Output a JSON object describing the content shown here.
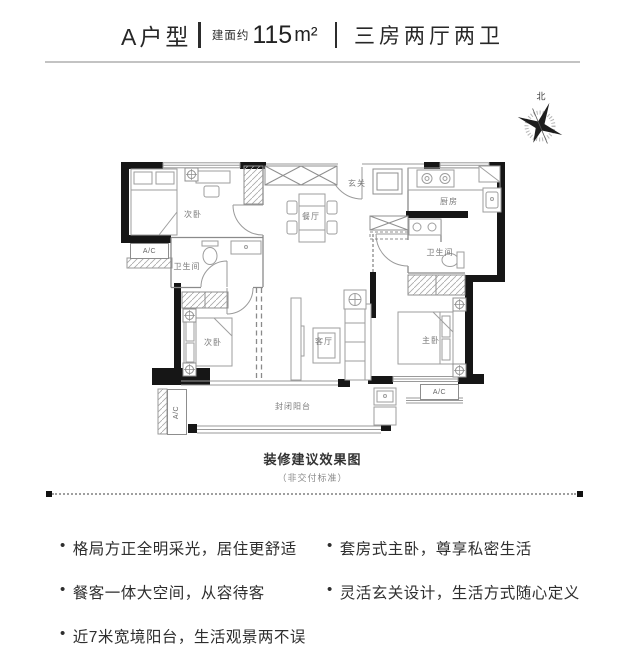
{
  "header": {
    "unit_name": "A户型",
    "area_prefix": "建面约",
    "area_value": "115",
    "area_unit": "m²",
    "layout_desc": "三房两厅两卫"
  },
  "floor_plan": {
    "compass_label": "北",
    "ac_label": "A/C",
    "rooms": {
      "bedroom_top": "次卧",
      "dining": "餐厅",
      "entry": "玄关",
      "kitchen": "厨房",
      "bath_left": "卫生间",
      "bath_right": "卫生间",
      "bedroom_bottom": "次卧",
      "living": "客厅",
      "master": "主卧",
      "balcony": "封闭阳台"
    }
  },
  "caption": {
    "title": "装修建议效果图",
    "subtitle": "（非交付标准）"
  },
  "features": {
    "bullet": "•",
    "left": [
      "格局方正全明采光，居住更舒适",
      "餐客一体大空间，从容待客",
      "近7米宽境阳台，生活观景两不误"
    ],
    "right": [
      "套房式主卧，尊享私密生活",
      "灵活玄关设计，生活方式随心定义"
    ]
  }
}
